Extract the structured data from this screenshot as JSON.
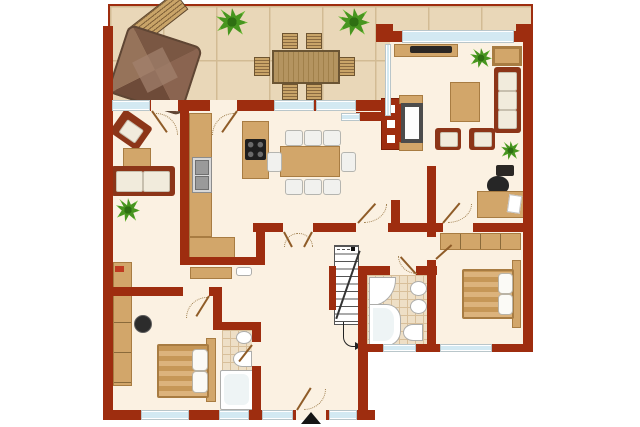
{
  "meta": {
    "type": "architectural-floor-plan",
    "view": "top-down furnished color plan",
    "visible_text": "none"
  },
  "colors": {
    "wall": "#9e2d0f",
    "wall_dark": "#7c1f06",
    "floor": "#fbf1e2",
    "terrace_tile": "#e9d7b8",
    "tile_grout": "#d2bb94",
    "glass": "#d3e9f2",
    "wood": "#d2a66a",
    "wood_dark": "#a87c42",
    "upholstery": "#8c3518",
    "cushion": "#f1ebdc",
    "plant_green": "#47951f",
    "bath_tile": "#eedfc6",
    "bath_grout": "#d8bf9a",
    "fixture": "#ffffff",
    "dark": "#2b2724",
    "white_bg": "#ffffff"
  },
  "rooms": [
    {
      "name": "terrace"
    },
    {
      "name": "sitting-room"
    },
    {
      "name": "kitchen"
    },
    {
      "name": "dining-area"
    },
    {
      "name": "living-room"
    },
    {
      "name": "office-corner"
    },
    {
      "name": "hallway"
    },
    {
      "name": "staircase"
    },
    {
      "name": "bathroom-main"
    },
    {
      "name": "shower-room"
    },
    {
      "name": "bedroom-left"
    },
    {
      "name": "bedroom-right"
    }
  ],
  "furniture": {
    "terrace": [
      "parasol",
      "garden-bench",
      "outdoor-dining-table",
      "outdoor-chair x6",
      "potted-plant x2"
    ],
    "sitting_room": [
      "armchair",
      "side-table",
      "loveseat-sofa",
      "potted-plant"
    ],
    "kitchen": [
      "counter-with-sink",
      "lower-counter",
      "cooktop-island"
    ],
    "dining_area": [
      "dining-table",
      "dining-chair x8",
      "fireplace"
    ],
    "living_room": [
      "tv-lowboard",
      "tv",
      "armchair",
      "sofa",
      "coffee-table",
      "armchair x2",
      "potted-plant x2"
    ],
    "office_corner": [
      "desk",
      "document",
      "office-chair",
      "printer"
    ],
    "hallway": [
      "sideboard",
      "shelf"
    ],
    "bathroom_main": [
      "corner-shower",
      "corner-bathtub",
      "washbasin x2",
      "toilet"
    ],
    "shower_room": [
      "washbasin",
      "toilet",
      "bathtub"
    ],
    "bedroom_left": [
      "wardrobe",
      "stool",
      "double-bed",
      "pillow x2"
    ],
    "bedroom_right": [
      "wardrobe",
      "double-bed",
      "pillow x2"
    ]
  },
  "openings": {
    "windows_count": 12,
    "interior_doors_count": 10,
    "entrance": "bottom-center door marked with black triangle arrow"
  },
  "markers": {
    "entrance_arrow": "black upward triangle below main entrance door"
  }
}
